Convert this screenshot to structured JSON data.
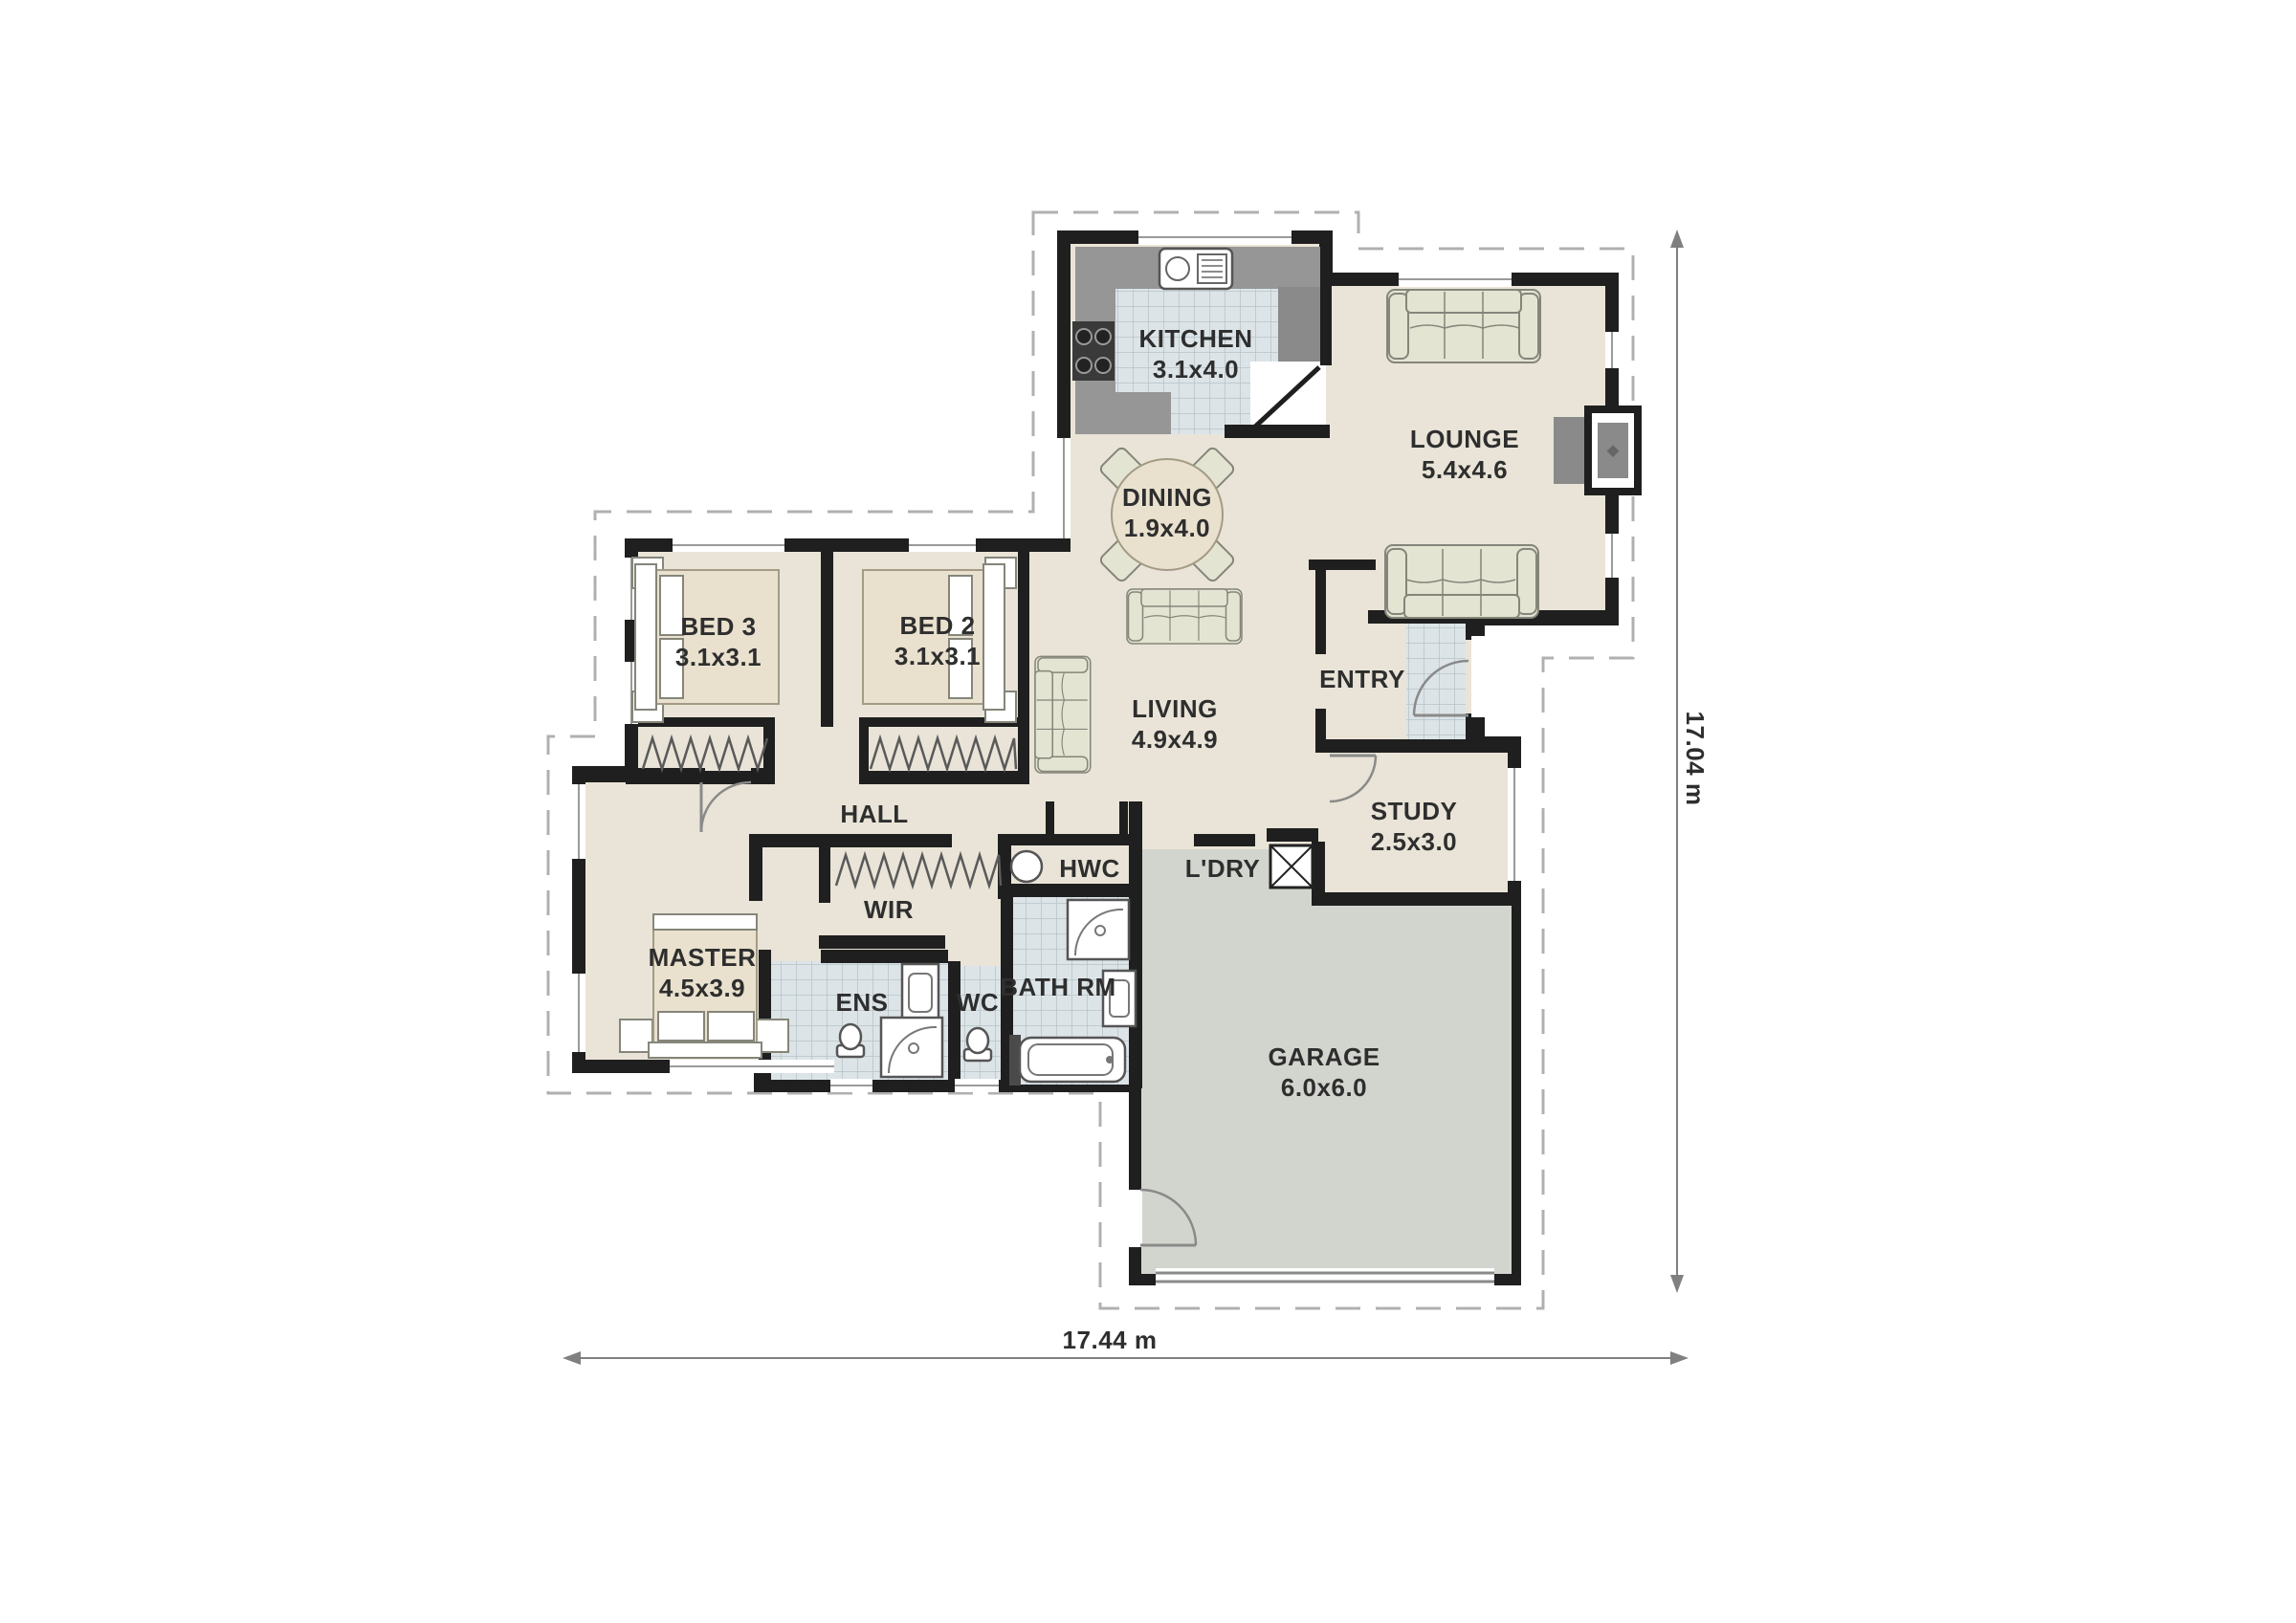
{
  "rooms": {
    "kitchen": {
      "name": "KITCHEN",
      "size": "3.1x4.0"
    },
    "lounge": {
      "name": "LOUNGE",
      "size": "5.4x4.6"
    },
    "dining": {
      "name": "DINING",
      "size": "1.9x4.0"
    },
    "living": {
      "name": "LIVING",
      "size": "4.9x4.9"
    },
    "entry": {
      "name": "ENTRY"
    },
    "study": {
      "name": "STUDY",
      "size": "2.5x3.0"
    },
    "bed3": {
      "name": "BED 3",
      "size": "3.1x3.1"
    },
    "bed2": {
      "name": "BED 2",
      "size": "3.1x3.1"
    },
    "hall": {
      "name": "HALL"
    },
    "wir": {
      "name": "WIR"
    },
    "hwc": {
      "name": "HWC"
    },
    "ldry": {
      "name": "L'DRY"
    },
    "master": {
      "name": "MASTER",
      "size": "4.5x3.9"
    },
    "ens": {
      "name": "ENS"
    },
    "wc": {
      "name": "WC"
    },
    "bathrm": {
      "name": "BATH RM"
    },
    "garage": {
      "name": "GARAGE",
      "size": "6.0x6.0"
    }
  },
  "dimensions": {
    "overall_width": "17.44 m",
    "overall_height": "17.04 m"
  },
  "colors": {
    "floor": "#e9e4d7",
    "wall": "#1f1f1f",
    "tile_bg": "#dce4e7",
    "tile_grid": "#b6c3c9",
    "garage_floor": "#d2d5ce",
    "counter": "#969696",
    "counter_dark": "#8a8a8a",
    "furniture": "#e4e4d2",
    "furniture_outline": "#85857a",
    "bed_spread": "#e9e1ce",
    "bed_outline": "#a39b85",
    "dashed_outline": "#b0b0b0",
    "dimension_line": "#808080",
    "text": "#2e2e2e",
    "fixture": "#ffffff",
    "fixture_outline": "#555555",
    "dark_band": "#4a4a4a"
  }
}
